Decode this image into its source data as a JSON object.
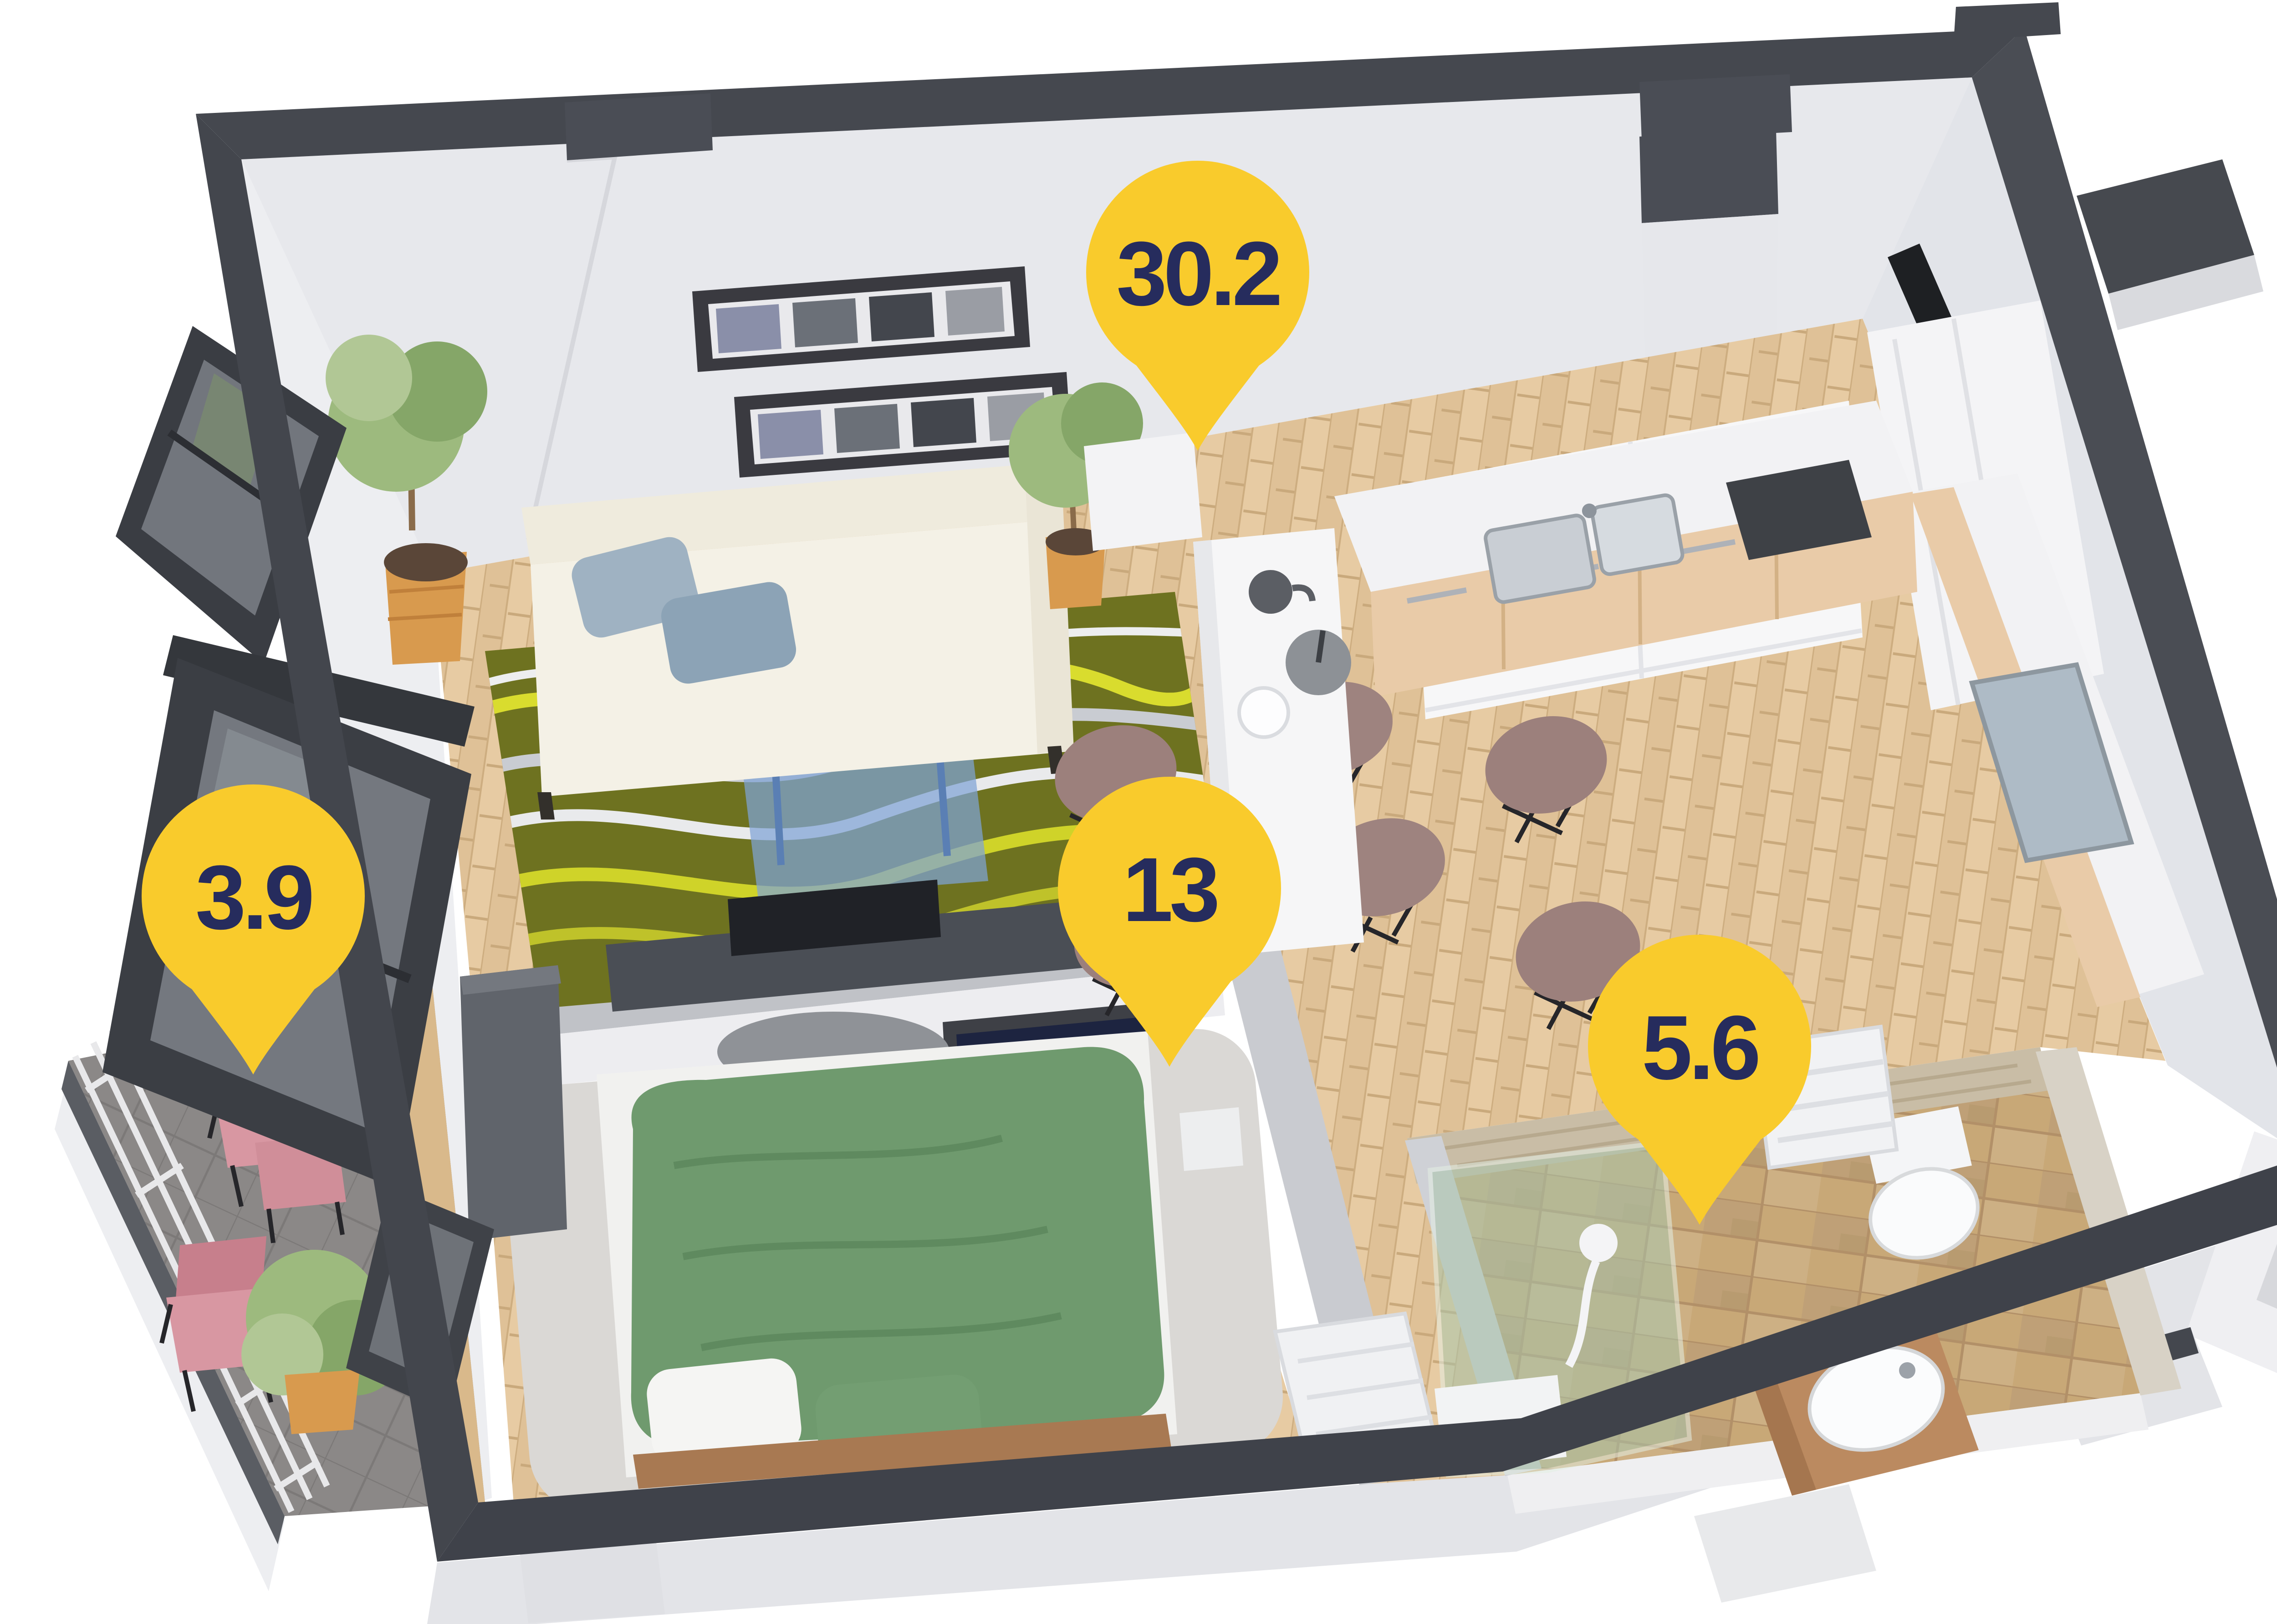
{
  "scene": {
    "kind": "isometric-apartment-floorplan-render",
    "background": "#ffffff"
  },
  "pins": [
    {
      "room": "living-room-kitchen",
      "area": "30.2"
    },
    {
      "room": "bedroom",
      "area": "13"
    },
    {
      "room": "bathroom",
      "area": "5.6"
    },
    {
      "room": "balcony",
      "area": "3.9"
    }
  ],
  "pin_style": {
    "fill": "#F9CB2C",
    "text_color": "#262C5D"
  },
  "palette": {
    "wall_top": "#45484F",
    "wall_face": "#E7E8EC",
    "wood_floor": "#E7CBA3",
    "rug_olive": "#6E7220",
    "bed_green": "#6F9A6E",
    "bath_tile": "#C8A877",
    "balcony_floor": "#8B8887",
    "chair_pink": "#D897A2"
  }
}
